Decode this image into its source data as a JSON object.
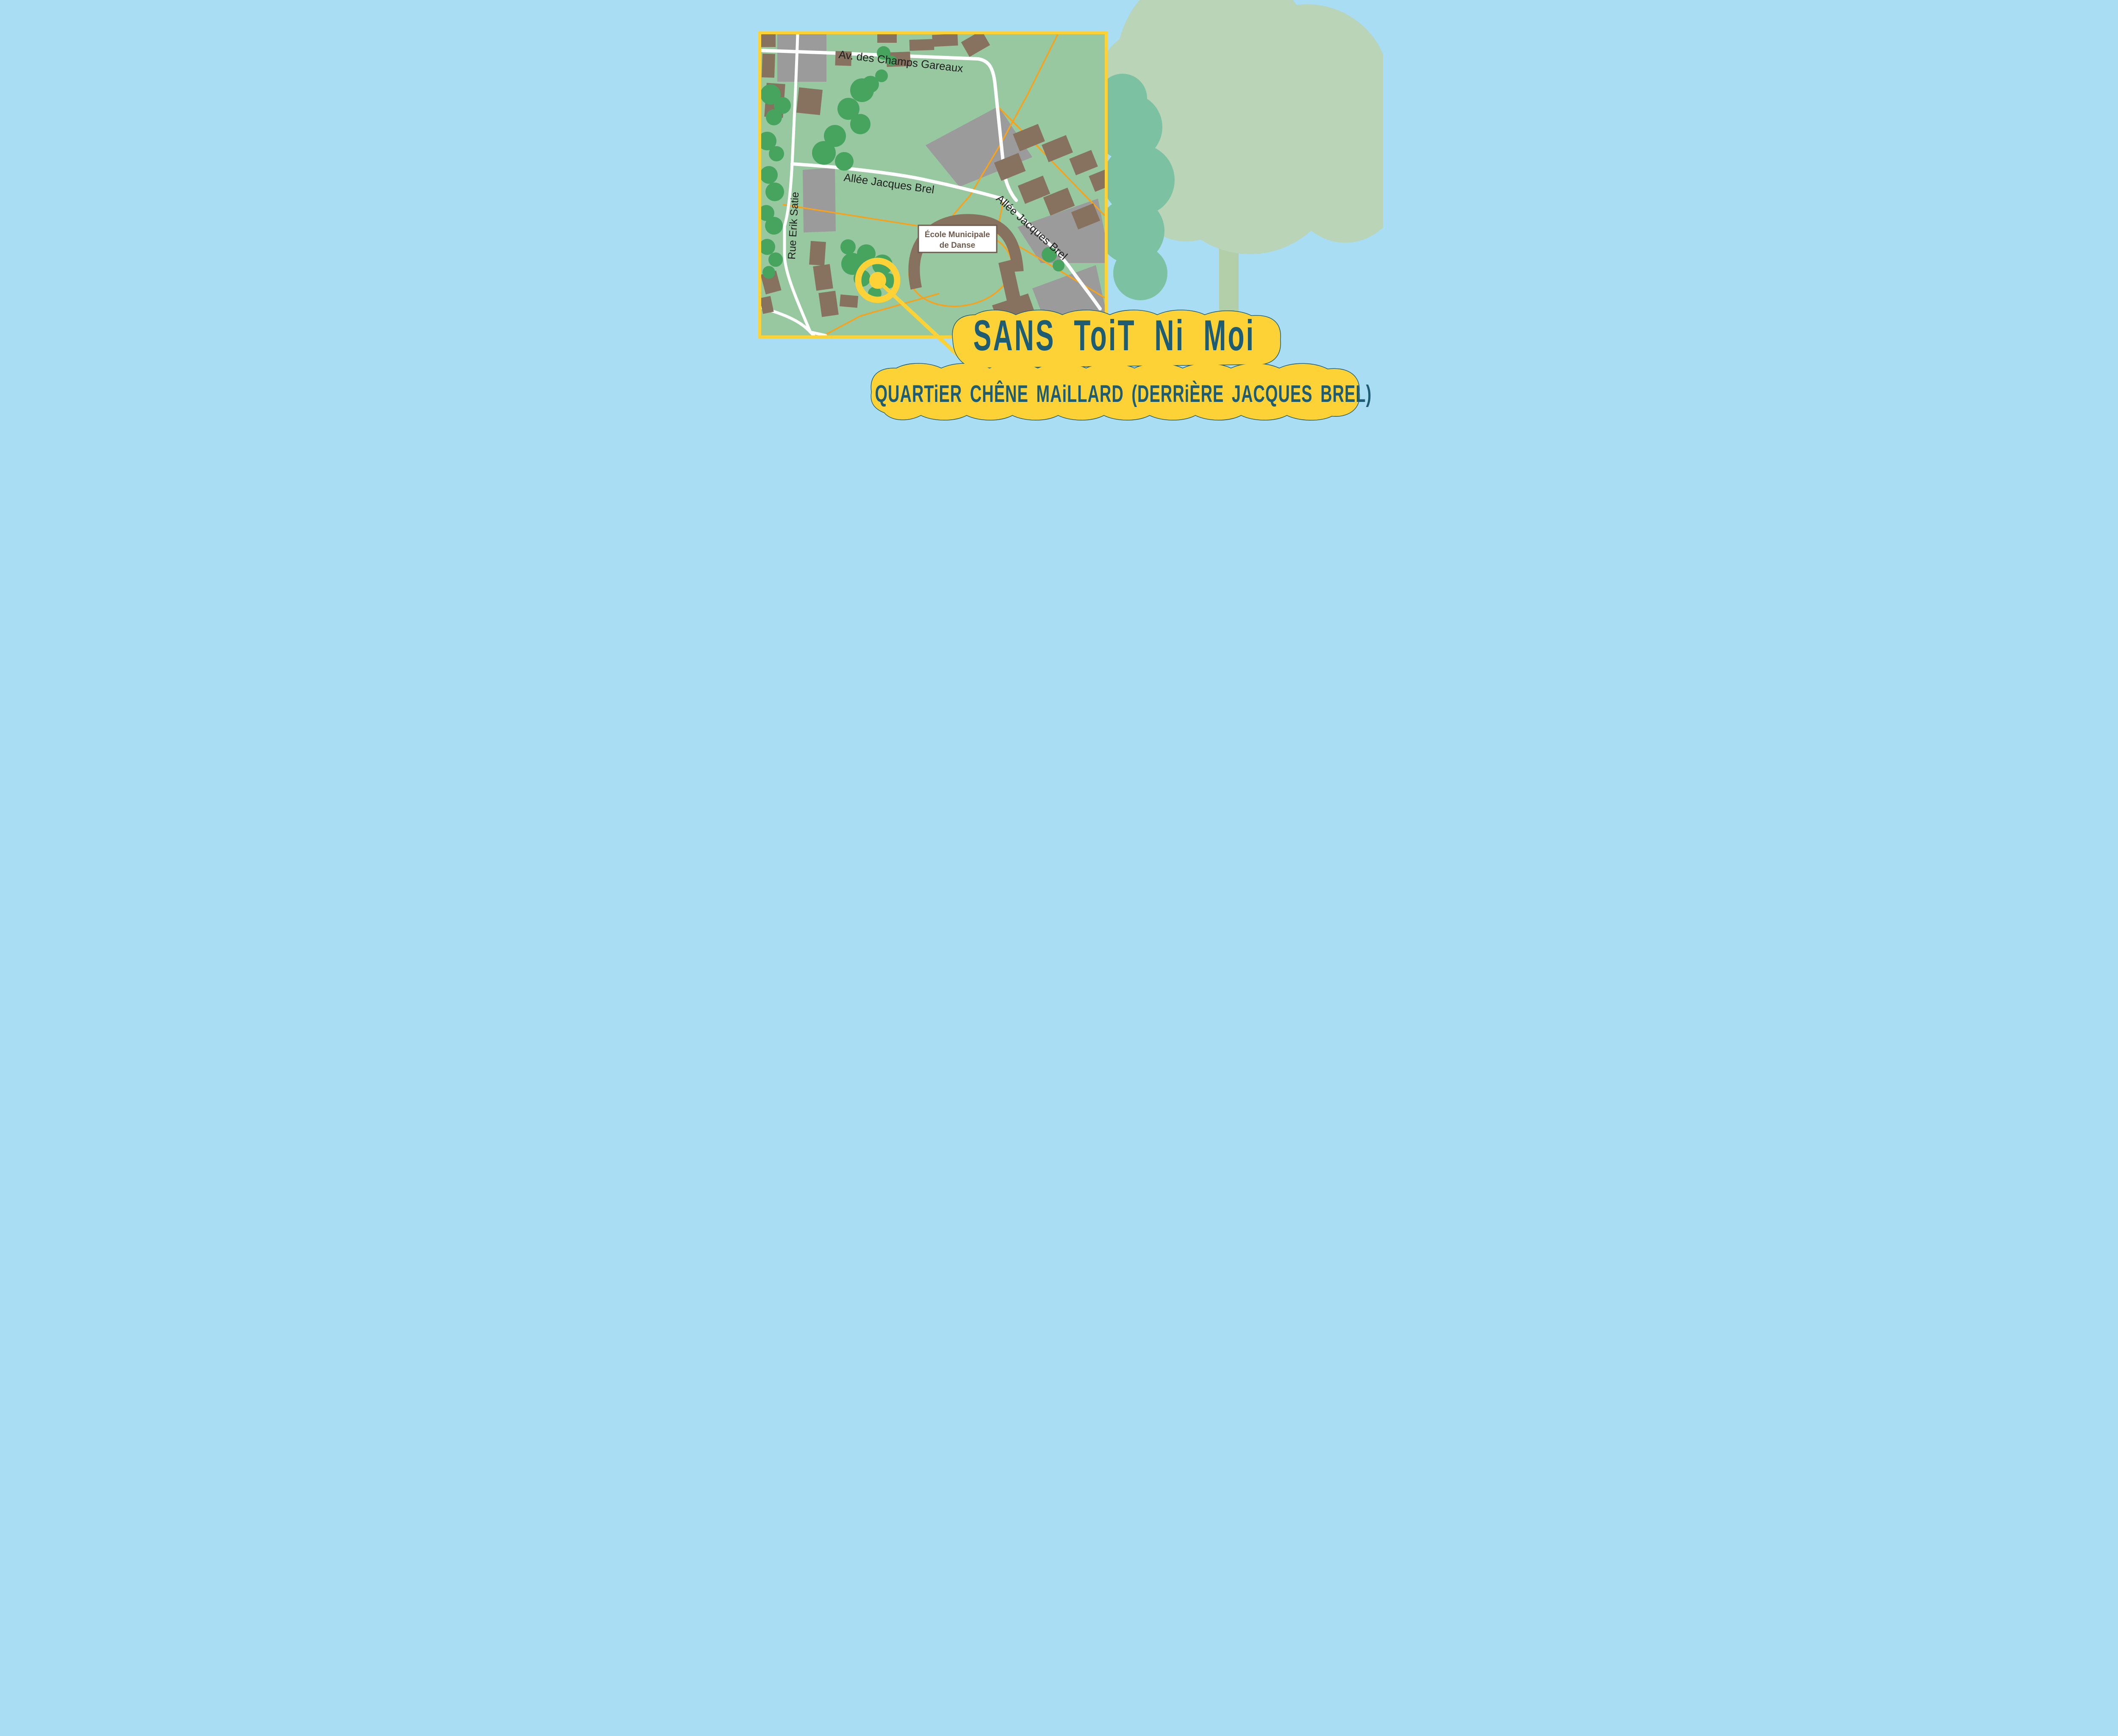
{
  "map": {
    "streets": {
      "avenue": "Av. des Champs Gareaux",
      "allee_horizontal": "Allée Jacques Brel",
      "allee_diagonal": "Allée Jacques Brel",
      "rue": "Rue Erik Satie"
    },
    "school": {
      "line1": "École Municipale",
      "line2": "de Danse"
    },
    "marker": {
      "icon": "bullseye-location-marker"
    }
  },
  "banner": {
    "title": "SANS ToiT Ni Moi",
    "subtitle": "QUARTiER CHÊNE MAiLLARD (DERRiÈRE JACQUES BREL)"
  },
  "colors": {
    "sky": "#A8DDF4",
    "map_green": "#97C8A0",
    "tree_green": "#46A45E",
    "road_white": "#FFFFFF",
    "footpath_orange": "#F6A21D",
    "building_brown": "#86725F",
    "paved_gray": "#9B9B9B",
    "accent_yellow": "#FCD237",
    "text_teal": "#1D5C72",
    "big_tree_canopy": "#B9D4B6",
    "big_tree_trunk": "#B3CFA9",
    "background_tree": "#7CC2A2",
    "school_brown": "#6F5B4D",
    "street_label": "#1F1F1F"
  }
}
